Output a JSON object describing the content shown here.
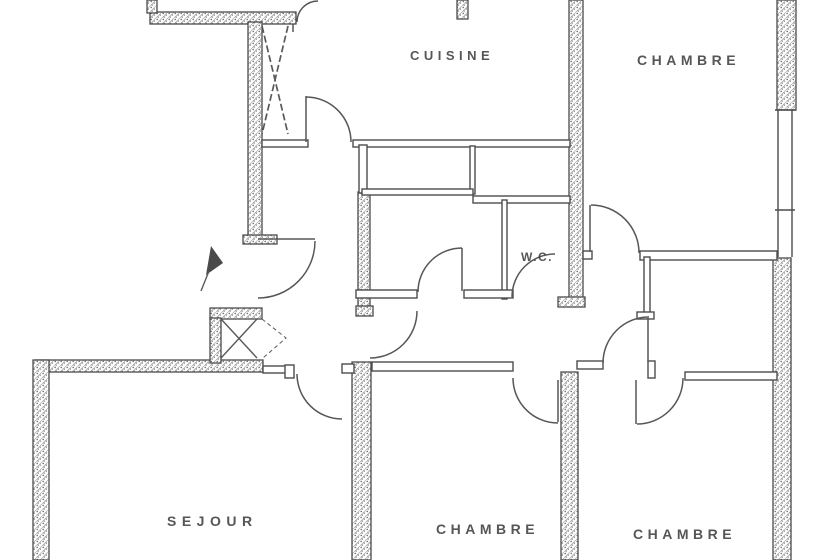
{
  "plan": {
    "background_color": "#ffffff",
    "ink_color": "#474747",
    "wall_fill_style": "stippled-hatch",
    "rooms": {
      "cuisine": {
        "label": "CUISINE"
      },
      "chambre_top_right": {
        "label": "CHAMBRE"
      },
      "wc": {
        "label": "W.C."
      },
      "sejour": {
        "label": "SEJOUR"
      },
      "chambre_bottom_middle": {
        "label": "CHAMBRE"
      },
      "chambre_bottom_right": {
        "label": "CHAMBRE"
      }
    },
    "symbols": {
      "entrance_arrow": "entrance-arrow-icon",
      "closet_cross": "closet-cross-icon",
      "glazed_panel_cross": "glazed-panel-cross-icon",
      "door_swings": "door-swing-arc"
    }
  }
}
